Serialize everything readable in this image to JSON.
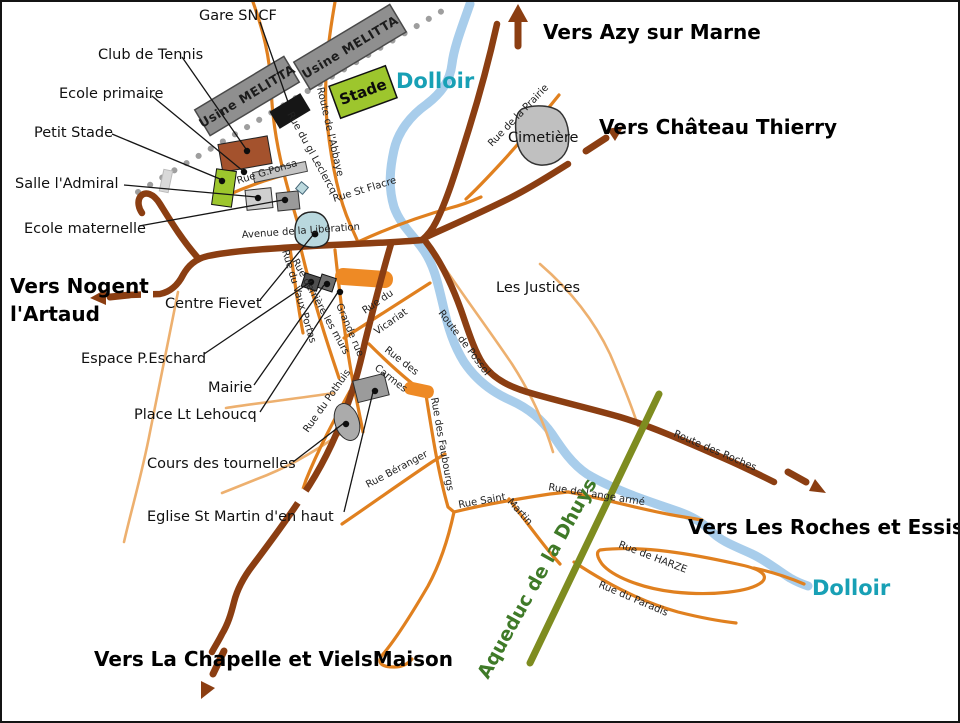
{
  "directions": {
    "azy": "Vers Azy sur Marne",
    "chateau": "Vers Château Thierry",
    "nogent1": "Vers Nogent",
    "nogent2": "l'Artaud",
    "roches": "Vers Les Roches et Essises",
    "chapelle": "Vers La Chapelle et VielsMaison"
  },
  "water": {
    "dolloir_top": "Dolloir",
    "dolloir_right": "Dolloir"
  },
  "aqueduct": {
    "label": "Aqueduc de la Dhuys"
  },
  "buildings": {
    "usine1": "Usine MELITTA",
    "usine2": "Usine MELITTA",
    "stade": "Stade"
  },
  "places": {
    "gare": "Gare SNCF",
    "club_tennis": "Club de Tennis",
    "ecole_primaire": "Ecole primaire",
    "petit_stade": "Petit Stade",
    "salle_admiral": "Salle l'Admiral",
    "ecole_maternelle": "Ecole maternelle",
    "centre_fievet": "Centre Fievet",
    "espace_eschard": "Espace P.Eschard",
    "mairie": "Mairie",
    "place_lehoucq": "Place Lt Lehoucq",
    "cours_tournelles": "Cours des tournelles",
    "eglise": "Eglise St Martin d'en haut",
    "cimetiere": "Cimetière",
    "les_justices": "Les Justices"
  },
  "streets": {
    "route_abbaye": "Route de l'Abbaye",
    "rue_leclercq": "Rue du gl Leclercq",
    "rue_ponsa": "Rue G.Ponsa",
    "rue_st_flacre": "Rue St Flacre",
    "avenue_liberation": "Avenue de la Libération",
    "rue_prairie": "Rue de la Prairie",
    "rue_vaux_portas": "Rue du Vaux Portas",
    "rue_derriere_murs": "Rue derrière les murs",
    "grande_rue": "Grande rue",
    "rue_vicariat_1": "Rue du",
    "rue_vicariat_2": "Vicariat",
    "rue_carmes_1": "Rue des",
    "rue_carmes_2": "Carmes",
    "rue_pothuis": "Rue du Pothuis",
    "route_possol": "Route de Possol",
    "rue_faubourgs": "Rue des Faubourgs",
    "rue_beranger": "Rue Béranger",
    "rue_saint_1": "Rue Saint",
    "rue_saint_2": "Martin",
    "rue_ange_arme": "Rue de l'ange armé",
    "rue_harze": "Rue de HARZE",
    "rue_paradis": "Rue du Paradis",
    "route_roches": "Route des Roches"
  },
  "colors": {
    "main_road": "#8B3E12",
    "street": "#E0801F",
    "river": "#A8CDEB",
    "river_label": "#18A0B5",
    "aqueduct": "#7E8C20",
    "aqueduct_label": "#3F7A28",
    "stade_green": "#9DC62D",
    "building_gray": "#8F8F8F"
  }
}
